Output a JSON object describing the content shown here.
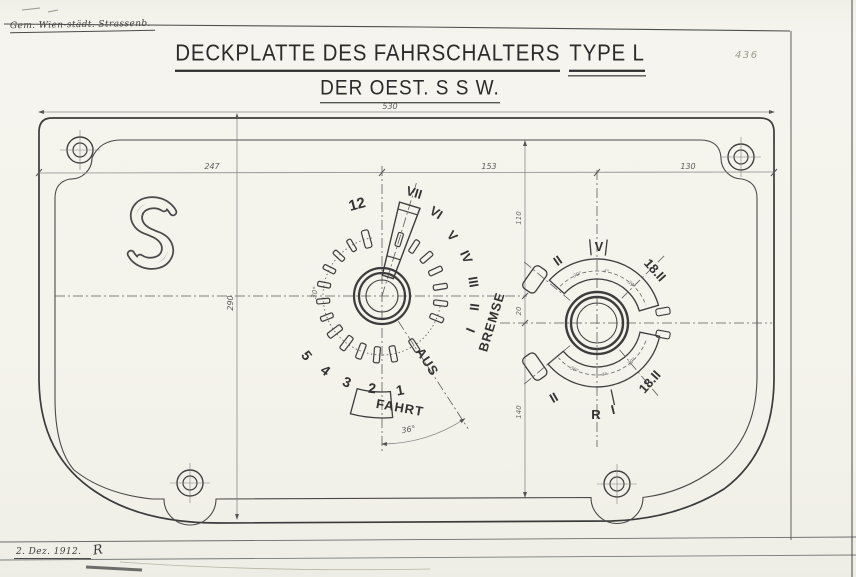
{
  "sheet": {
    "stamp": "Gem. Wien-städt. Strassenb.",
    "page_number": "436",
    "title": {
      "main": "DECKPLATTE DES FAHRSCHALTERS",
      "type": "TYPE L",
      "sub": "DER OEST. S S W."
    },
    "footer": {
      "date": "2. Dez. 1912.",
      "signature": "R"
    }
  },
  "drawing": {
    "dims": {
      "total": "530",
      "left": "247",
      "middle": "153",
      "right": "130",
      "height": "290",
      "upper": "110",
      "between": "20",
      "lower": "140"
    },
    "main_dial": {
      "twelve": "12",
      "drive": [
        "1",
        "2",
        "3",
        "4",
        "5"
      ],
      "brake": [
        "I",
        "II",
        "III",
        "IV",
        "V",
        "VI",
        "VII"
      ],
      "aus": "AUS",
      "fahrt": "FAHRT",
      "bremse": "BREMSE",
      "angle_fahrt": "36°",
      "angle_aus": "30°"
    },
    "reverser": {
      "top_left": "II",
      "top_center": "V",
      "top_right": "18.II",
      "bottom_left": "II",
      "bottom_center": "R",
      "bottom_tick": "I",
      "bottom_right": "18.II",
      "deg": [
        "30°",
        "4°",
        "39°",
        "39°",
        "4°",
        "30°"
      ]
    }
  }
}
